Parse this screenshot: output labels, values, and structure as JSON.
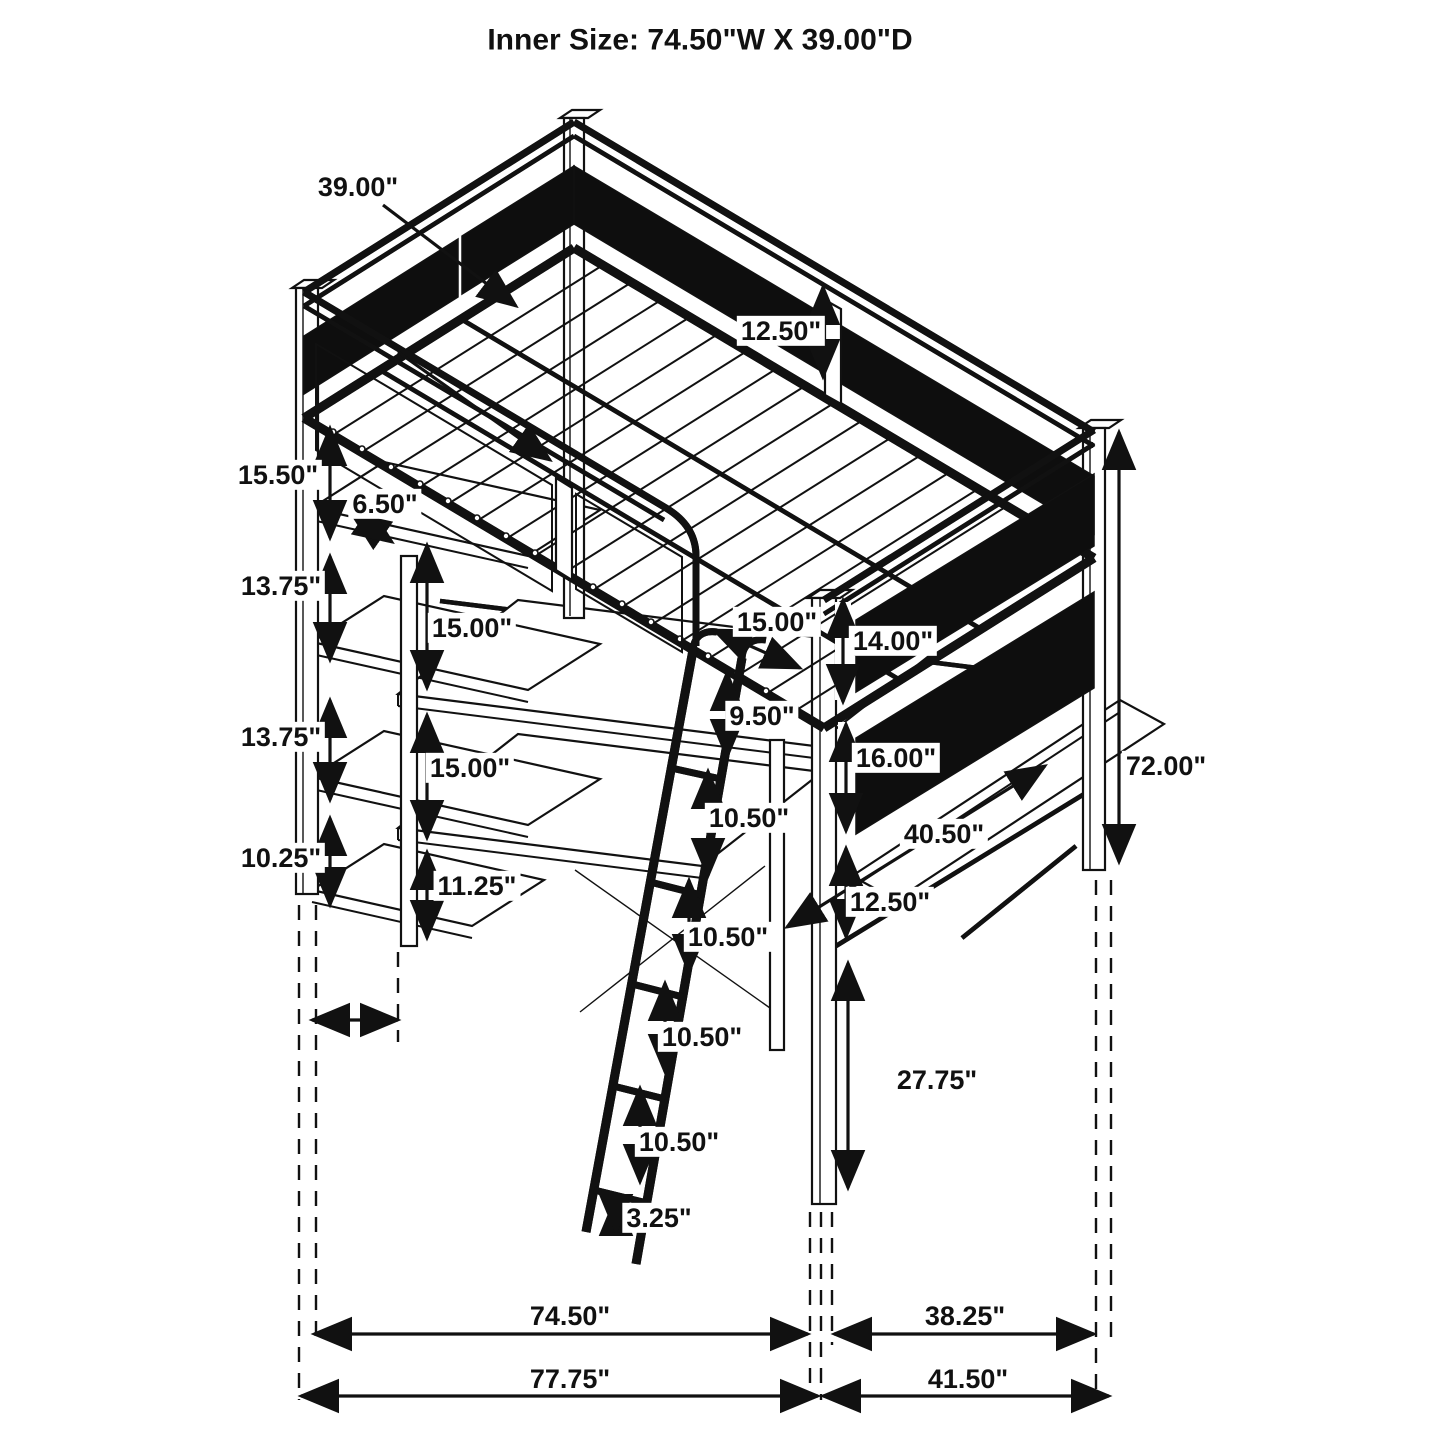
{
  "title": "Inner Size: 74.50\"W X 39.00\"D",
  "diagram": {
    "type": "isometric dimension line drawing",
    "subject": "metal twin loft bed with under-bed desk, side shelves and angled ladder",
    "line_color": "#111111",
    "mesh_color": "#0e0e0e",
    "background": "#ffffff"
  },
  "labels": {
    "d39": "39.00\"",
    "d1250a": "12.50\"",
    "d1550": "15.50\"",
    "d650": "6.50\"",
    "d1375a": "13.75\"",
    "d1500a": "15.00\"",
    "d1375b": "13.75\"",
    "d1500b": "15.00\"",
    "d1025": "10.25\"",
    "d1125": "11.25\"",
    "d1500c": "15.00\"",
    "d1400": "14.00\"",
    "d950": "9.50\"",
    "d1600": "16.00\"",
    "d1050a": "10.50\"",
    "d1050b": "10.50\"",
    "d1050c": "10.50\"",
    "d1050d": "10.50\"",
    "d325": "3.25\"",
    "d4050": "40.50\"",
    "d1250b": "12.50\"",
    "d2775": "27.75\"",
    "d7200": "72.00\"",
    "d7450": "74.50\"",
    "d3825": "38.25\"",
    "d7775": "77.75\"",
    "d4150": "41.50\""
  },
  "dimension_semantics": {
    "bed_depth_leader": "39.00\"",
    "guardrail_above_deck": "12.50\"",
    "deck_to_top_shelf": "15.50\"",
    "shelf_board_depth": "6.50\"",
    "shelf_gap_upper": "13.75\"",
    "shelf_gap_lower": "13.75\"",
    "shelf_to_bottom_rail": "10.25\"",
    "desk_clearance_upper": "15.00\"",
    "desk_clearance_lower": "15.00\"",
    "shelf_post_to_floor": "11.25\"",
    "ladder_opening_width": "15.00\"",
    "footboard_rail_height": "14.00\"",
    "deck_to_first_rung": "9.50\"",
    "foot_mesh_panel_height": "16.00\"",
    "rung_spacing": [
      "10.50\"",
      "10.50\"",
      "10.50\"",
      "10.50\""
    ],
    "last_rung_to_ladder_end": "3.25\"",
    "desk_diagonal_depth": "40.50\"",
    "mesh_to_desk_stretcher": "12.50\"",
    "stretcher_to_floor": "27.75\"",
    "overall_height": "72.00\"",
    "inner_width_at_floor": "74.50\"",
    "inner_depth_at_floor": "38.25\"",
    "outer_width_at_floor": "77.75\"",
    "outer_depth_at_floor": "41.50\""
  }
}
